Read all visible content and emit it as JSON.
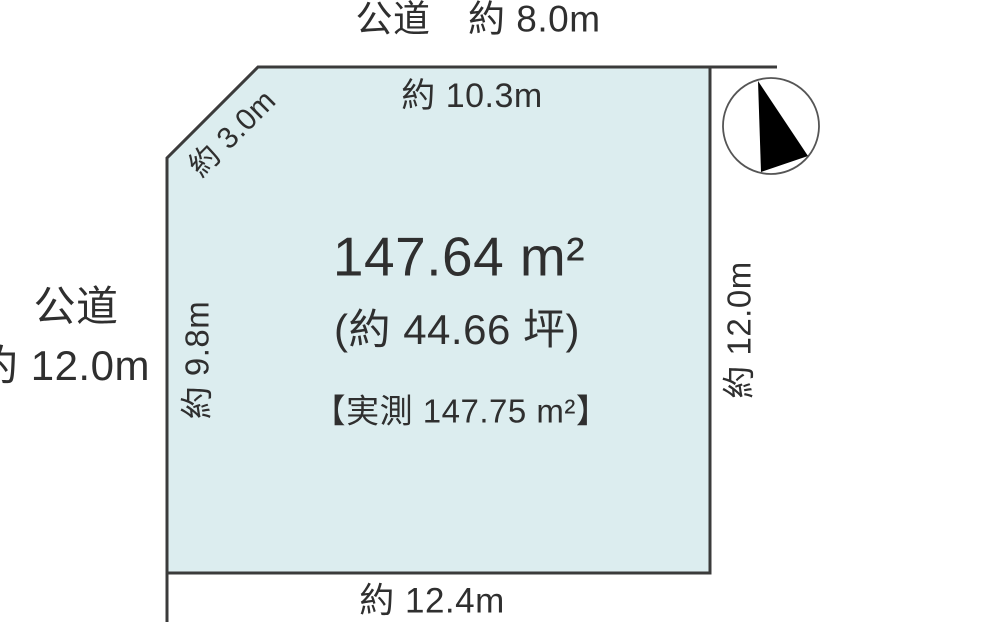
{
  "diagram": {
    "roads": {
      "top": "公道　約 8.0m",
      "left_line1": "公道",
      "left_line2": "約 12.0m"
    },
    "edges": {
      "top": "約 10.3m",
      "diagonal": "約 3.0m",
      "left": "約 9.8m",
      "right": "約 12.0m",
      "bottom": "約 12.4m"
    },
    "area": {
      "main": "147.64 m²",
      "tsubo": "(約 44.66 坪)",
      "measured": "【実測 147.75 m²】"
    },
    "icons": {
      "compass": "north-arrow-icon"
    },
    "colors": {
      "plot_fill": "#dcedef",
      "outline": "#3b3b3b",
      "text": "#2f2f2f",
      "compass_black": "#000000"
    }
  }
}
